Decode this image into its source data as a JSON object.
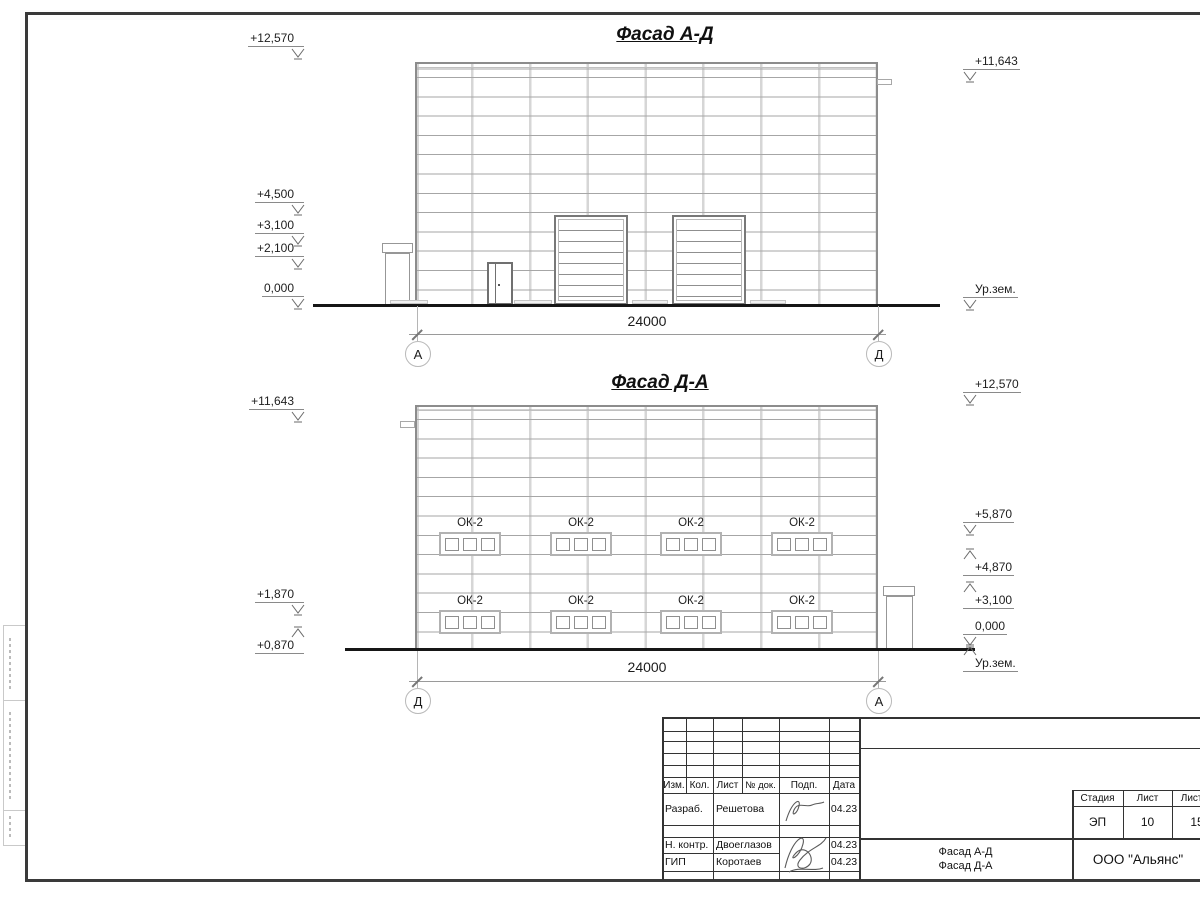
{
  "facade_top": {
    "title": "Фасад А-Д",
    "dimension_label": "24000",
    "axis_left": "А",
    "axis_right": "Д",
    "marks": {
      "left": [
        "+12,570",
        "+4,500",
        "+3,100",
        "+2,100",
        "0,000"
      ],
      "right": [
        "+11,643",
        "Ур.зем."
      ]
    }
  },
  "facade_bottom": {
    "title": "Фасад Д-А",
    "dimension_label": "24000",
    "axis_left": "Д",
    "axis_right": "А",
    "window_label": "ОК-2",
    "marks": {
      "left": [
        "+11,643",
        "+1,870",
        "+0,870"
      ],
      "right": [
        "+12,570",
        "+5,870",
        "+4,870",
        "+3,100",
        "0,000",
        "Ур.зем."
      ]
    }
  },
  "titleblock": {
    "columns": [
      "Изм.",
      "Кол.",
      "Лист",
      "№ док.",
      "Подп.",
      "Дата"
    ],
    "rows": [
      {
        "role": "Разраб.",
        "name": "Решетова",
        "date": "04.23"
      },
      {
        "role": "Н. контр.",
        "name": "Двоеглазов",
        "date": "04.23"
      },
      {
        "role": "ГИП",
        "name": "Коротаев",
        "date": "04.23"
      }
    ],
    "stage": {
      "headers": [
        "Стадия",
        "Лист",
        "Листов"
      ],
      "values": [
        "ЭП",
        "10",
        "15"
      ]
    },
    "doc_title_line1": "Фасад А-Д",
    "doc_title_line2": "Фасад Д-А",
    "company": "ООО \"Альянс\""
  }
}
